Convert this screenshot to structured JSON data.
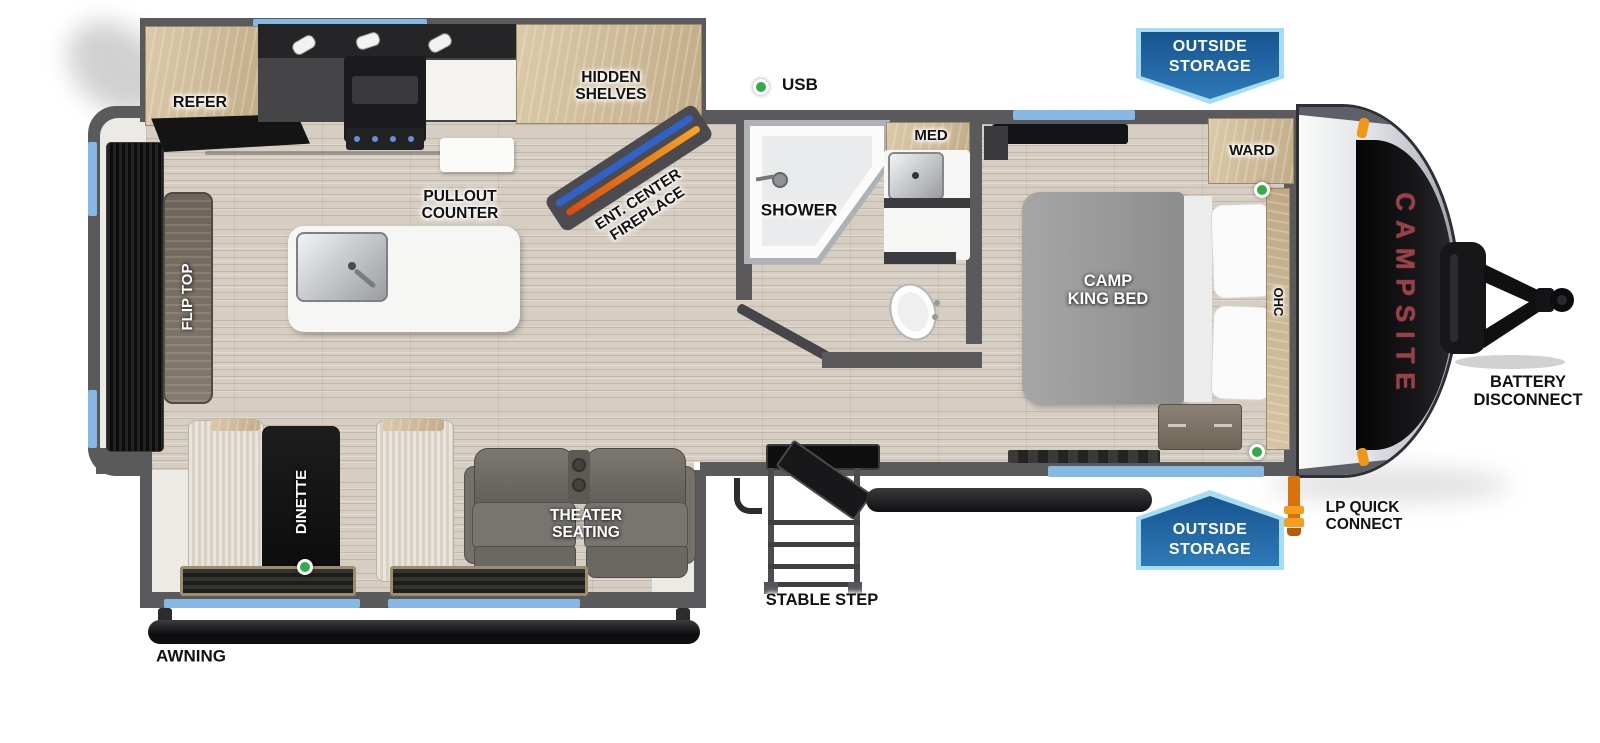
{
  "floorplan": {
    "brand_graphic": "CAMPSITE",
    "labels": {
      "refer": "REFER",
      "hidden_shelves": [
        "HIDDEN",
        "SHELVES"
      ],
      "usb": "USB",
      "outside_storage": [
        "OUTSIDE",
        "STORAGE"
      ],
      "pullout_counter": [
        "PULLOUT",
        "COUNTER"
      ],
      "ent_center_fireplace": [
        "ENT. CENTER",
        "FIREPLACE"
      ],
      "shower": "SHOWER",
      "med": "MED",
      "ward": "WARD",
      "camp_king_bed": [
        "CAMP",
        "KING BED"
      ],
      "ohc": "OHC",
      "battery_disconnect": [
        "BATTERY",
        "DISCONNECT"
      ],
      "lp_quick_connect": [
        "LP QUICK",
        "CONNECT"
      ],
      "stable_step": "STABLE STEP",
      "theater_seating": [
        "THEATER",
        "SEATING"
      ],
      "dinette": "DINETTE",
      "flip_top": "FLIP TOP",
      "awning": "AWNING"
    },
    "markers": {
      "usb_dot": "green-dot",
      "dinette_dot": "green-dot",
      "ward_dot": "green-dot",
      "bedroom_dot": "green-dot"
    },
    "colors": {
      "banner_blue": "#2e7ab8",
      "banner_border": "#a5ddf2",
      "window_blue": "#85b9e4",
      "marker_green": "#2fae47",
      "brand_red": "#9b4046",
      "wall_gray": "#5a5a5d",
      "floor_tan": "#d6cec2",
      "lp_orange": "#e07b10"
    }
  }
}
